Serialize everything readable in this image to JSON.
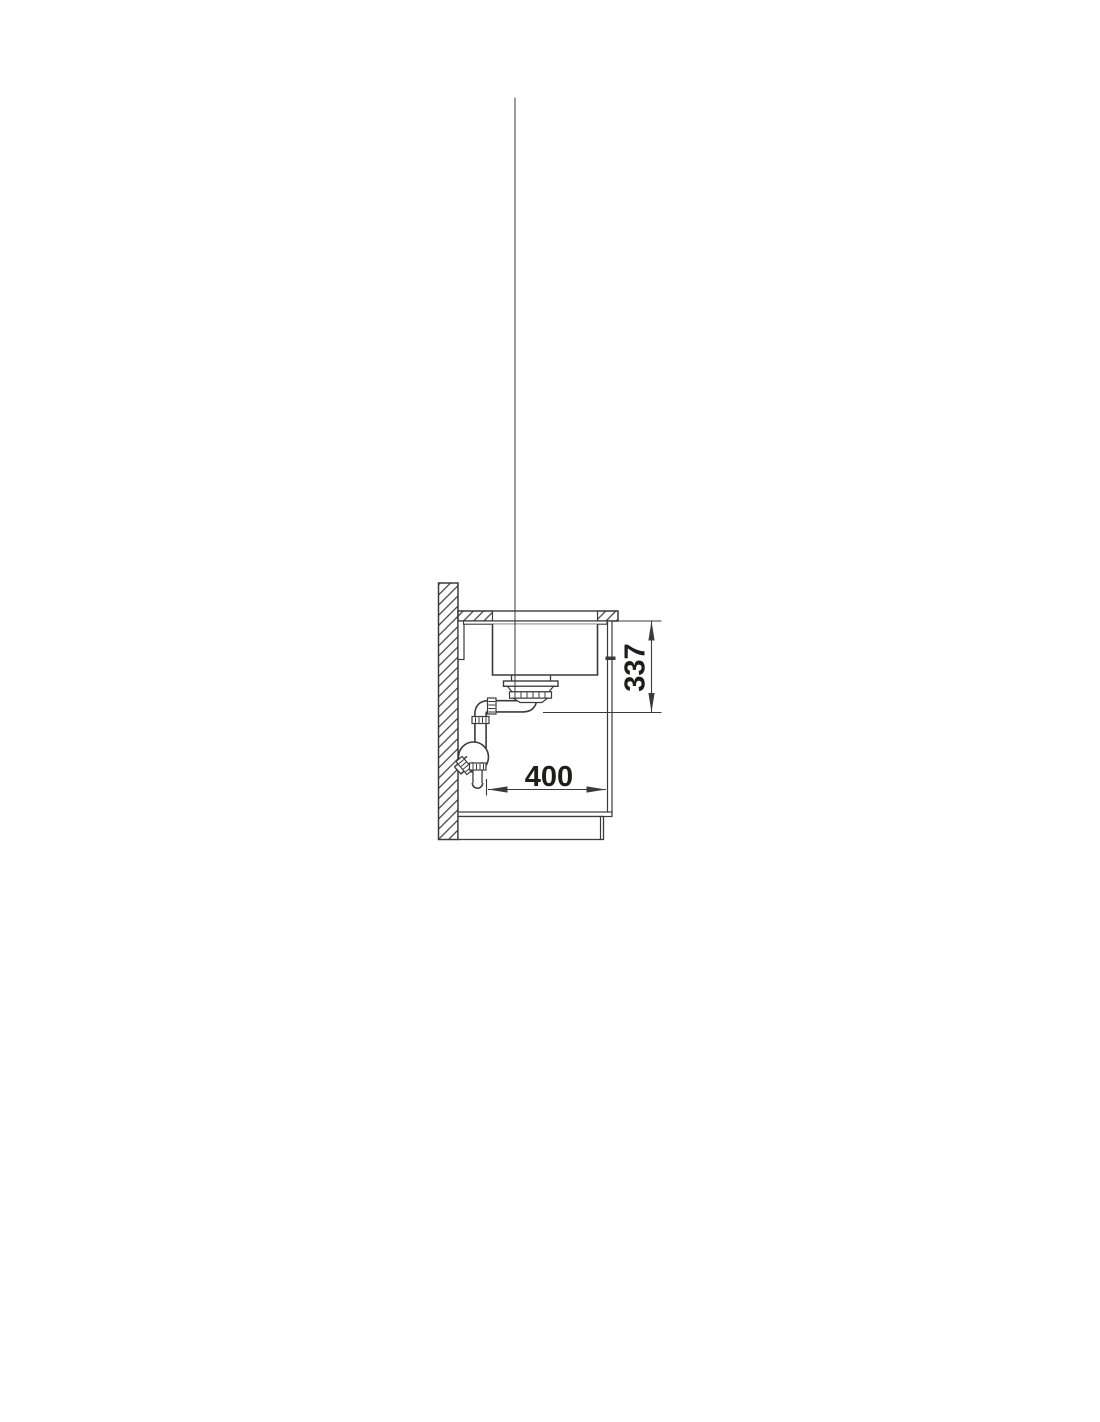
{
  "page": {
    "background_color": "#ffffff",
    "line_color": "#3b3b3b",
    "text_color": "#1d1d1b"
  },
  "diagram": {
    "type": "technical-cross-section",
    "subject": "undermount sink installation side view with siphon",
    "dimensions": {
      "vertical_clearance": {
        "value": "337",
        "orientation": "vertical"
      },
      "horizontal_clearance": {
        "value": "400",
        "orientation": "horizontal"
      }
    },
    "components": [
      "wall",
      "countertop",
      "wall-batten",
      "sink-rim",
      "sink-basin",
      "drain-strainer",
      "drain-pipe",
      "union-nuts",
      "trap-bowl",
      "wall-outlet-stub",
      "tailpipe",
      "cabinet-side-panel",
      "cabinet-bottom-panel",
      "plinth"
    ]
  }
}
